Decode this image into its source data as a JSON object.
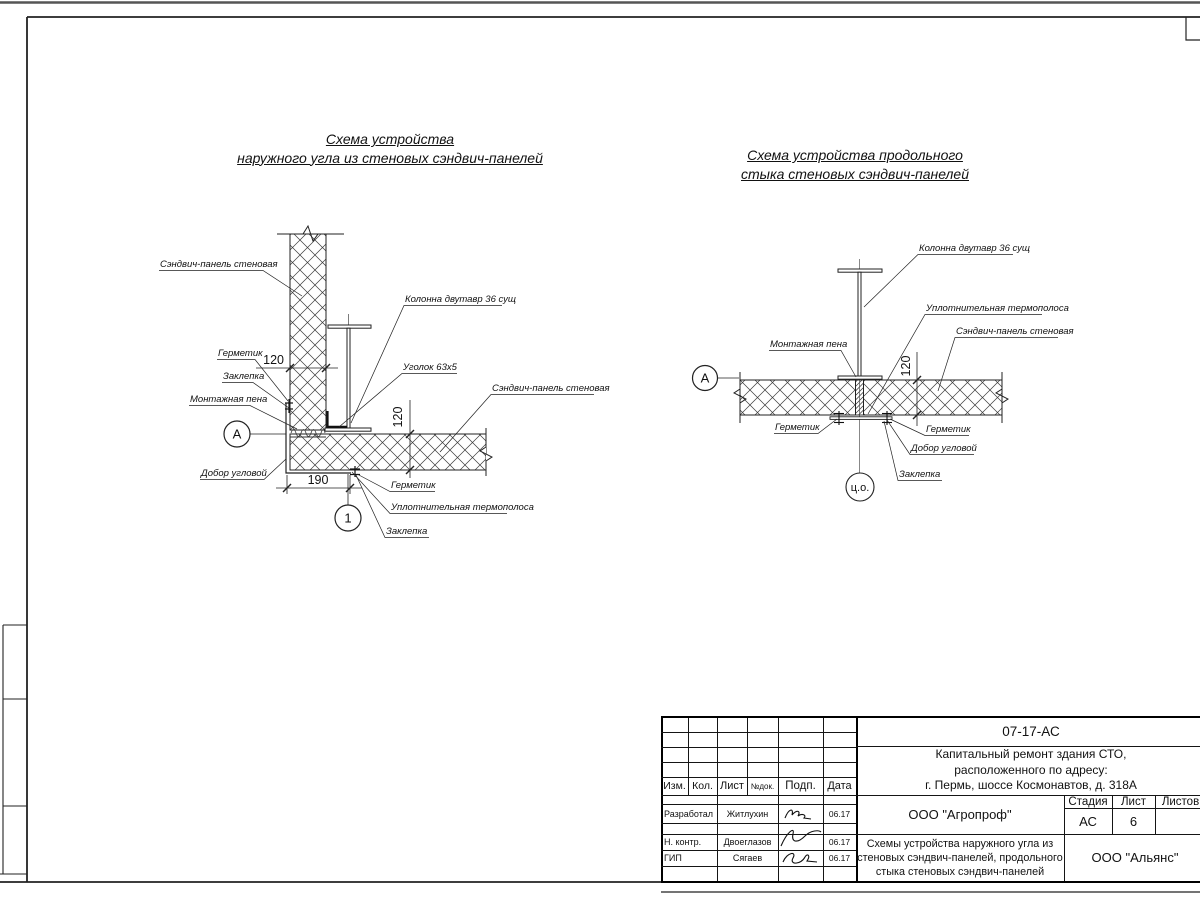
{
  "left_diagram": {
    "title1": "Схема устройства",
    "title2": "наружного угла из стеновых сэндвич-панелей",
    "labels": {
      "panel": "Сэндвич-панель стеновая",
      "column": "Колонна двутавр 36 сущ",
      "sealant_top": "Герметик",
      "rivet_top": "Заклепка",
      "foam": "Монтажная пена",
      "corner_trim": "Добор угловой",
      "angle": "Уголок 63х5",
      "panel_right": "Сэндвич-панель стеновая",
      "sealant_bottom": "Герметик",
      "thermo_strip": "Уплотнительная термополоса",
      "rivet_bottom": "Заклепка"
    },
    "dims": {
      "wall_thickness": "120",
      "panel_thickness": "120",
      "corner_width": "190"
    },
    "markers": {
      "node": "А",
      "detail": "1"
    }
  },
  "right_diagram": {
    "title1": "Схема устройства продольного",
    "title2": "стыка стеновых сэндвич-панелей",
    "labels": {
      "column": "Колонна двутавр 36 сущ",
      "thermo_strip": "Уплотнительная термополоса",
      "panel": "Сэндвич-панель стеновая",
      "foam": "Монтажная пена",
      "sealant_left": "Герметик",
      "sealant_right": "Герметик",
      "corner_trim": "Добор угловой",
      "rivet": "Заклепка"
    },
    "dims": {
      "panel_thickness": "120"
    },
    "markers": {
      "node": "А",
      "axis": "ц.о."
    }
  },
  "titleblock": {
    "doc_number": "07-17-АС",
    "project_line1": "Капитальный ремонт здания СТО,",
    "project_line2": "расположенного по адресу:",
    "project_line3": "г. Пермь, шоссе Космонавтов, д. 318А",
    "header": {
      "izm": "Изм.",
      "kol": "Кол.",
      "list": "Лист",
      "ndok": "№док.",
      "podp": "Подп.",
      "data": "Дата"
    },
    "rows": [
      {
        "role": "Разработал",
        "name": "Житлухин",
        "date": "06.17"
      },
      {
        "role": "Н. контр.",
        "name": "Двоеглазов",
        "date": "06.17"
      },
      {
        "role": "ГИП",
        "name": "Сягаев",
        "date": "06.17"
      }
    ],
    "org_design": "ООО \"Агропроф\"",
    "stage_label": "Стадия",
    "sheet_label": "Лист",
    "sheets_label": "Листов",
    "stage": "АС",
    "sheet_number": "6",
    "sheets_total": "",
    "title_line1": "Схемы устройства наружного угла из",
    "title_line2": "стеновых сэндвич-панелей, продольного",
    "title_line3": "стыка стеновых сэндвич-панелей",
    "org_customer": "ООО \"Альянс\""
  }
}
